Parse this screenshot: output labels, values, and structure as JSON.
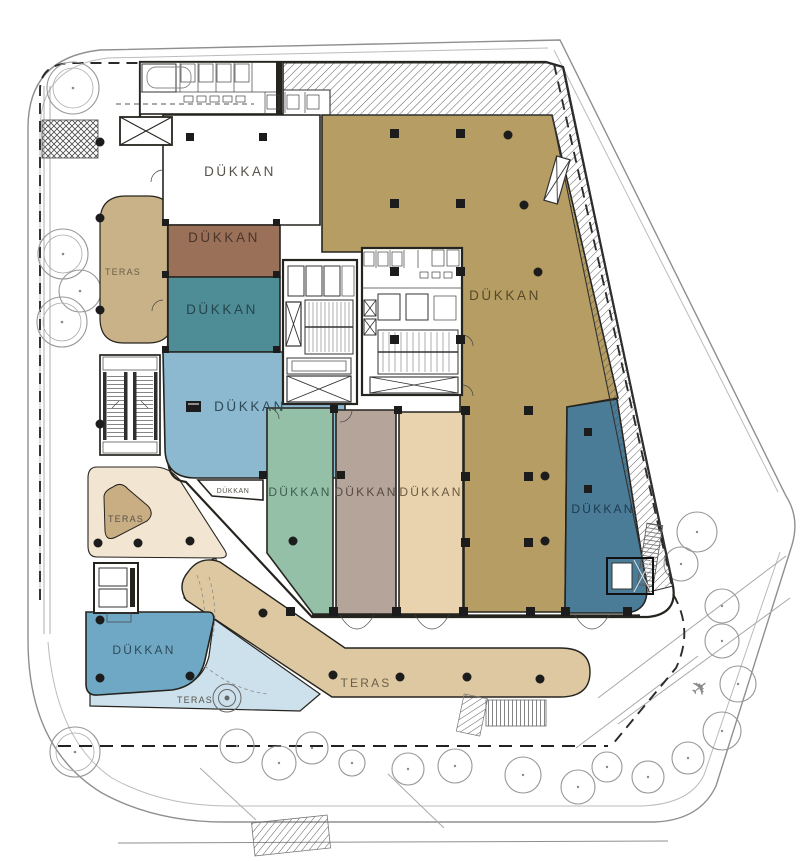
{
  "labels": {
    "shop": "DÜKKAN",
    "terrace": "TERAS"
  },
  "rooms": {
    "shop_top": {
      "label": "DÜKKAN",
      "color": "#ffffff"
    },
    "shop_brown": {
      "label": "DÜKKAN",
      "color": "#9a7058"
    },
    "shop_teal": {
      "label": "DÜKKAN",
      "color": "#4e8c96"
    },
    "shop_lightblue": {
      "label": "DÜKKAN",
      "color": "#8cb8d0"
    },
    "shop_mini": {
      "label": "DÜKKAN",
      "color": "#ffffff"
    },
    "shop_green": {
      "label": "DÜKKAN",
      "color": "#95c0a8"
    },
    "shop_taupe": {
      "label": "DÜKKAN",
      "color": "#b5a49a"
    },
    "shop_beige": {
      "label": "DÜKKAN",
      "color": "#e9d3ae"
    },
    "shop_khaki": {
      "label": "DÜKKAN",
      "color": "#b59d63"
    },
    "shop_darkblue": {
      "label": "DÜKKAN",
      "color": "#4a7b97"
    },
    "shop_corner": {
      "label": "DÜKKAN",
      "color": "#6fa8c4"
    }
  },
  "terraces": {
    "left": {
      "label": "TERAS",
      "color": "#c9b287"
    },
    "plaza": {
      "color": "#f2e6d2"
    },
    "plaza_triangle": {
      "label": "TERAS",
      "color": "#c9ae83"
    },
    "band": {
      "label": "TERAS",
      "color": "#ddc8a1"
    },
    "band_lightblue": {
      "label": "TERAS",
      "color": "#cde1ec"
    }
  },
  "colors": {
    "wall": "#26241f",
    "label_text": "#57534a",
    "site_line": "#8f8f8f",
    "site_line_light": "#bbbbbb",
    "column": "#1c1c1c",
    "hatch_line": "#4a4a4a",
    "paper": "#ffffff"
  },
  "icons": {
    "airplane": "✈"
  }
}
